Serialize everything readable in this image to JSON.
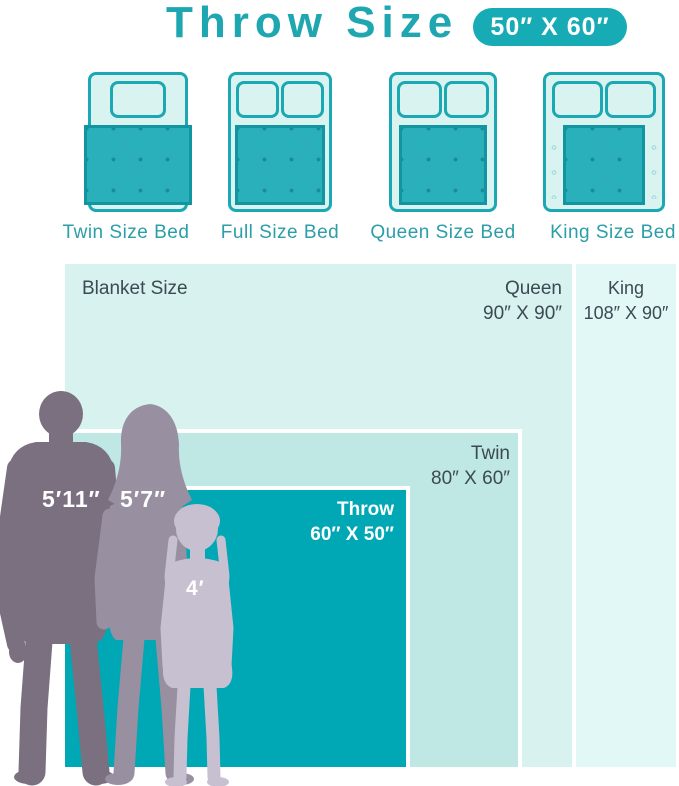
{
  "header": {
    "title": "Throw Size",
    "badge": "50″ X 60″"
  },
  "beds": [
    {
      "label": "Twin Size Bed",
      "pillows": 1
    },
    {
      "label": "Full Size Bed",
      "pillows": 2
    },
    {
      "label": "Queen Size Bed",
      "pillows": 2
    },
    {
      "label": "King Size Bed",
      "pillows": 2
    }
  ],
  "chart": {
    "label": "Blanket Size",
    "sizes": [
      {
        "name": "Throw",
        "dimensions": "60″ X 50″",
        "width_in": 60,
        "height_in": 50
      },
      {
        "name": "Twin",
        "dimensions": "80″ X 60″",
        "width_in": 80,
        "height_in": 60
      },
      {
        "name": "Queen",
        "dimensions": "90″ X 90″",
        "width_in": 90,
        "height_in": 90
      },
      {
        "name": "King",
        "dimensions": "108″ X 90″",
        "width_in": 108,
        "height_in": 90
      }
    ]
  },
  "people": [
    {
      "name": "man",
      "height": "5′11″"
    },
    {
      "name": "woman",
      "height": "5′7″"
    },
    {
      "name": "girl",
      "height": "4′"
    }
  ],
  "colors": {
    "accent_teal": "#1ba8b2",
    "throw_fill": "#00a7b5",
    "twin_fill": "#bfe8e4",
    "queen_fill": "#d7f2ef",
    "king_fill": "#e2f8f7",
    "bed_fill": "#d9f3f1",
    "blanket_fill": "#29b0ba",
    "text_dark": "#3c4a52",
    "man_silhouette": "#7a7080",
    "woman_silhouette": "#988fa1",
    "girl_silhouette": "#c6c0d0"
  }
}
